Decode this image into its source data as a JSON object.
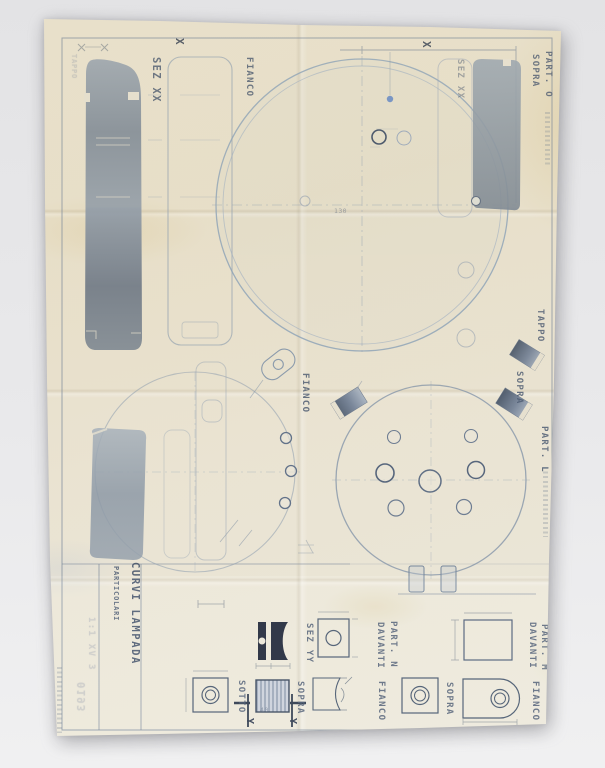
{
  "scene": {
    "description": "Photograph of a folded vintage blueprint sheet with lamp part drawings",
    "background_color": "#e9e9eb",
    "paper_color": "#eae3d0",
    "ink_color": "#8496ab",
    "shade_color": "#7c8a9b",
    "navy_color": "#232a3b"
  },
  "title_block": {
    "title": "CURVI LAMPADA",
    "subtitle": "PARTICOLARI",
    "scale_note": "1:1 XV 3",
    "stamp": "0193"
  },
  "labels": {
    "sez_xx": "SEZ XX",
    "fianco": "FIANCO",
    "sopra": "SOPRA",
    "sotto": "SOTTO",
    "davanti": "DAVANTI",
    "sez_yy": "SEZ YY",
    "tappo": "TAPPO",
    "part_o": "PART. O",
    "part_l": "PART. L",
    "part_n": "PART. N",
    "part_m": "PART. M",
    "x_mark": "X",
    "y_mark": "Y",
    "ghost_tappo": "TAPPO"
  },
  "dimensions": {
    "circle_diameter": "130",
    "block_width": "40"
  }
}
